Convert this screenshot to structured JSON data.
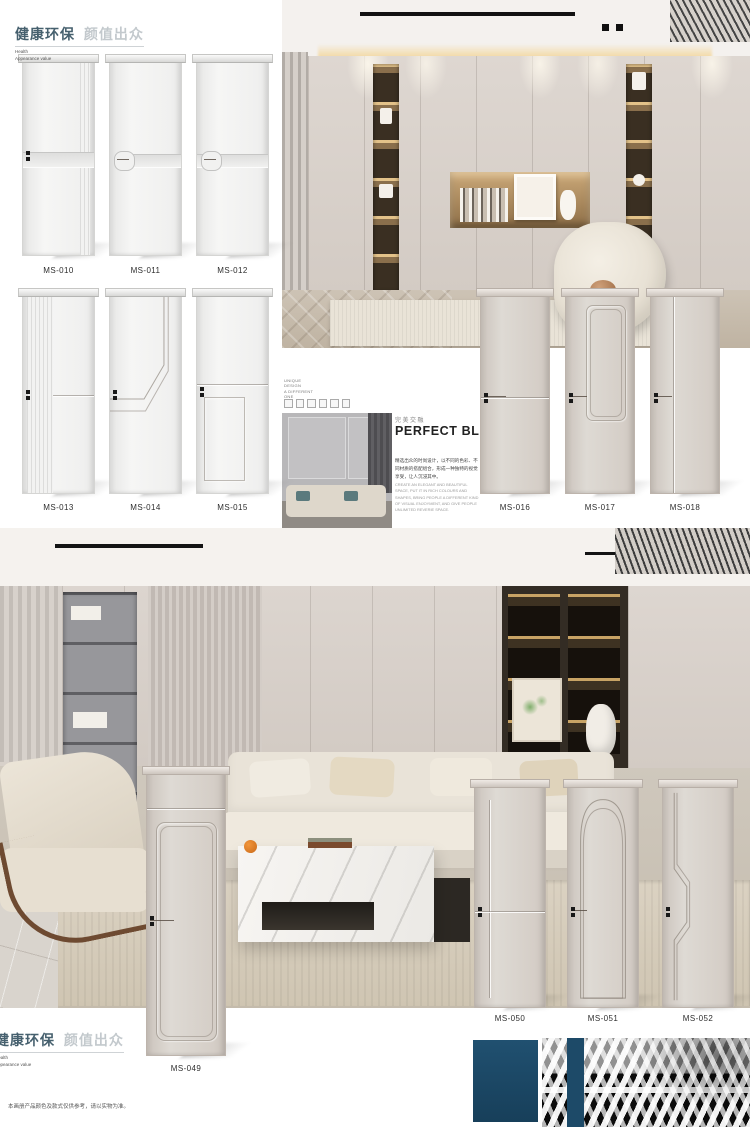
{
  "brand": {
    "cn_bold": "健康环保",
    "cn_light": "颜值出众",
    "en_line1": "Health",
    "en_line2": "Appearance value"
  },
  "page": {
    "corner_code": "MS-07",
    "disclaimer": "本画册产品颜色及款式仅供参考，请以实物为准。"
  },
  "feature": {
    "side_lines": [
      "UNIQUE",
      "DESIGN",
      "A DIFFERENT",
      "ONE"
    ],
    "title_cn": "完美交融",
    "title_en": "PERFECT BLEND",
    "body_cn": "精选出众的时尚设计，以不同的色彩、不同材质的搭配组合，形成一种独特的视觉享受，让人沉浸其中。",
    "body_en": "CREATE AN ELEGANT AND BEAUTIFUL SPACE, PUT IT IN RICH COLOURS AND SHAPES, BRING PEOPLE A DIFFERENT KIND OF VISUAL ENJOYMENT, AND GIVE PEOPLE UNLIMITED REVERIE SPACE."
  },
  "doors": {
    "row1": [
      {
        "code": "MS-010"
      },
      {
        "code": "MS-011"
      },
      {
        "code": "MS-012"
      }
    ],
    "row2": [
      {
        "code": "MS-013"
      },
      {
        "code": "MS-014"
      },
      {
        "code": "MS-015"
      }
    ],
    "row3": [
      {
        "code": "MS-016"
      },
      {
        "code": "MS-017"
      },
      {
        "code": "MS-018"
      }
    ],
    "featured": {
      "code": "MS-049"
    },
    "row4": [
      {
        "code": "MS-050"
      },
      {
        "code": "MS-051"
      },
      {
        "code": "MS-052"
      }
    ]
  },
  "colors": {
    "accent_blue": "#1d4a68",
    "logo_blue": "#46606e",
    "door_white": "#f3f3f2",
    "door_greige": "#d5cec8",
    "glow_warm": "#caa76b"
  }
}
